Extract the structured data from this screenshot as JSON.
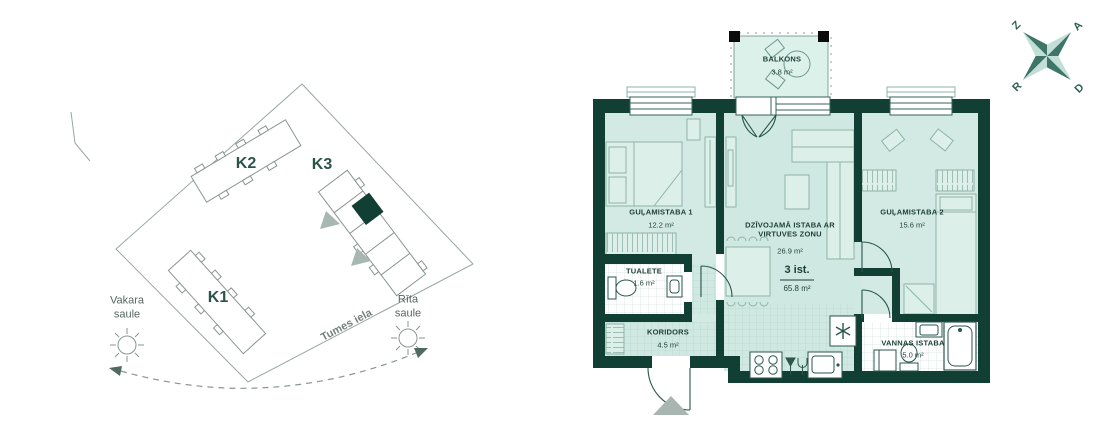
{
  "site_plan": {
    "buildings": [
      {
        "label": "K1"
      },
      {
        "label": "K2"
      },
      {
        "label": "K3"
      }
    ],
    "sun_west_label": "Vakara saule",
    "sun_east_label": "Rīta saule",
    "street_label": "Tumes iela"
  },
  "floor_plan": {
    "rooms": [
      {
        "name": "BALKONS",
        "area": "3.8 m²"
      },
      {
        "name": "GUĻAMISTABA 1",
        "area": "12.2 m²"
      },
      {
        "name": "DZĪVOJAMĀ ISTABA AR VIRTUVES ZONU",
        "area": "26.9 m²"
      },
      {
        "name": "GUĻAMISTABA 2",
        "area": "15.6 m²"
      },
      {
        "name": "TUALETE",
        "area": "1.6 m²"
      },
      {
        "name": "KORIDORS",
        "area": "4.5 m²"
      },
      {
        "name": "VANNAS ISTABA",
        "area": "5.0 m²"
      }
    ],
    "summary": {
      "rooms_count_label": "3 ist.",
      "total_area": "65.8 m²"
    }
  },
  "compass": {
    "north": "Z",
    "east": "A",
    "west": "R",
    "south": "D"
  },
  "colors": {
    "wall": "#123f33",
    "floor": "#d2eae3",
    "balcony_floor": "#dcf1ea",
    "fixture_line": "#2a564c",
    "furniture_line": "#8fb3a8",
    "marker_gray": "#a9b5b1",
    "compass_dark": "#3e7569",
    "compass_light": "#c3ded7"
  }
}
